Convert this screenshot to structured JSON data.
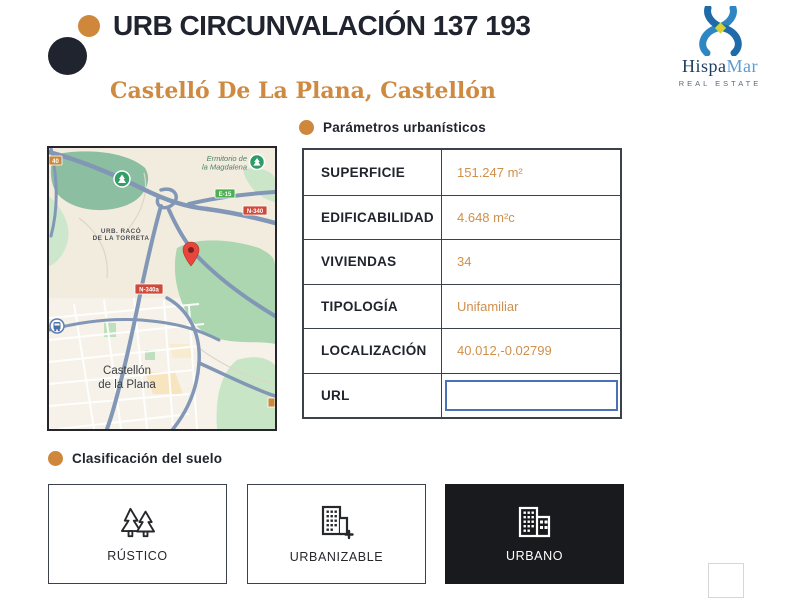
{
  "header": {
    "title": "URB CIRCUNVALACIÓN 137 193",
    "subtitle": "Castelló De La Plana, Castellón",
    "logo": {
      "name_primary": "Hispa",
      "name_secondary": "Mar",
      "tagline": "REAL ESTATE"
    }
  },
  "map": {
    "labels": {
      "ermitorio_line1": "Ermitorio de",
      "ermitorio_line2": "la Magdalena",
      "urb_line1": "URB. RACÓ",
      "urb_line2": "DE LA TORRETA",
      "city_line1": "Castellón",
      "city_line2": "de la Plana"
    },
    "badges": {
      "b40": "40",
      "e15": "E-15",
      "n340": "N-340",
      "n340a": "N-340a"
    }
  },
  "parameters": {
    "section_title": "Parámetros urbanísticos",
    "rows": [
      {
        "label": "SUPERFICIE",
        "value": "151.247 m²"
      },
      {
        "label": "EDIFICABILIDAD",
        "value": "4.648 m²c"
      },
      {
        "label": "VIVIENDAS",
        "value": "34"
      },
      {
        "label": "TIPOLOGÍA",
        "value": "Unifamiliar"
      },
      {
        "label": "LOCALIZACIÓN",
        "value": "40.012,-0.02799"
      },
      {
        "label": "URL",
        "value": ""
      }
    ]
  },
  "classification": {
    "section_title": "Clasificación del suelo",
    "options": [
      {
        "label": "RÚSTICO",
        "icon": "trees-icon",
        "selected": false
      },
      {
        "label": "URBANIZABLE",
        "icon": "building-plus-icon",
        "selected": false
      },
      {
        "label": "URBANO",
        "icon": "building-icon",
        "selected": true
      }
    ]
  },
  "colors": {
    "accent_orange": "#cf873c",
    "value_orange": "#d08f4b",
    "dark_navy": "#20242e",
    "table_border": "#3c424c",
    "input_blue": "#4a72b8",
    "selected_black": "#191a1d"
  }
}
